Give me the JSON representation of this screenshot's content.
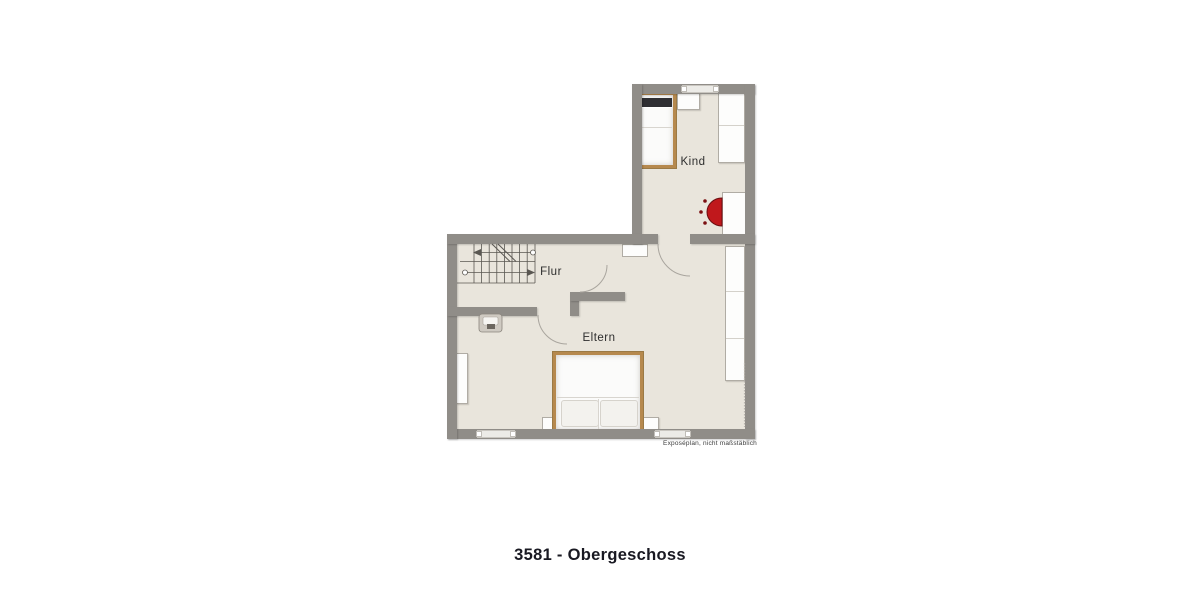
{
  "caption": "3581 - Obergeschoss",
  "floorplan": {
    "rooms": {
      "kind": {
        "label": "Kind"
      },
      "flur": {
        "label": "Flur"
      },
      "eltern": {
        "label": "Eltern"
      }
    },
    "disclaimer": "Exposéplan, nicht maßstäblich",
    "features": {
      "staircase": "u-shaped-stairs-with-direction-arrows",
      "stove": "wood-stove-icon",
      "washbasin": "washbasin-icon",
      "window_count": 3,
      "door_arc_count": 3,
      "beds": [
        "single-bed-kind",
        "double-bed-eltern"
      ],
      "wardrobes": [
        "wardrobe-kind",
        "built-in-closet-eltern",
        "cabinet-left-wall"
      ]
    },
    "colors": {
      "wall": "#908d88",
      "floor": "#e9e5dc",
      "bed_frame": "#b6894e",
      "stove_red": "#c0181c",
      "furniture_outline": "#b0aca4",
      "caption_text": "#191922"
    }
  }
}
